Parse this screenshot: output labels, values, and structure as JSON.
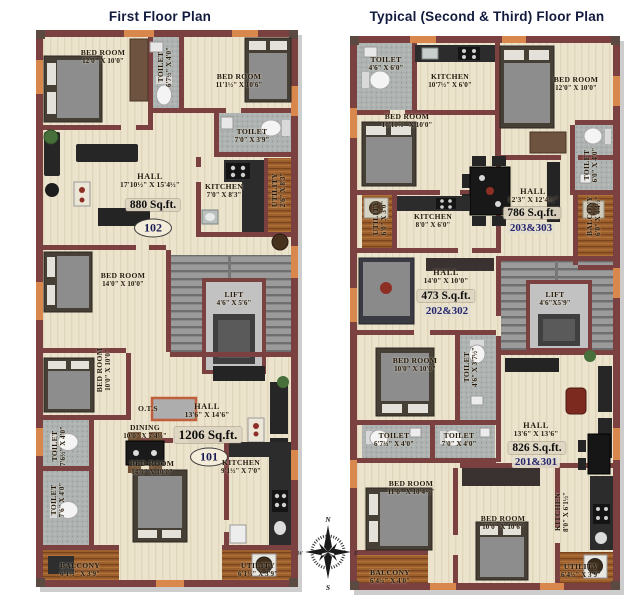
{
  "plans": {
    "left": {
      "title": "First Floor Plan",
      "rooms": {
        "bedroom_tl": {
          "name": "BED ROOM",
          "dims": "12'0\" X 10'0\""
        },
        "toilet_top": {
          "name": "TOILET",
          "dims": "6'7½\" X 4'0\""
        },
        "bedroom_tr": {
          "name": "BED ROOM",
          "dims": "11'1½\" X 10'6\""
        },
        "toilet_right": {
          "name": "TOILET",
          "dims": "7'0\" X 3'9\""
        },
        "hall_upper": {
          "name": "HALL",
          "dims": "17'10½\" X 15'4½\"",
          "area": "880 Sq.ft.",
          "unit": "102"
        },
        "kitchen_upper": {
          "name": "KITCHEN",
          "dims": "7'0\" X 8'3\""
        },
        "utility_side": {
          "name": "UTILITY",
          "dims": "2'6\" X 8'3\""
        },
        "bedroom_mid": {
          "name": "BED ROOM",
          "dims": "14'0\" X 10'0\""
        },
        "lift": {
          "name": "LIFT",
          "dims": "4'6\" X 5'6\""
        },
        "bedroom_small": {
          "name": "BED ROOM",
          "dims": "10'0\" X 10'0\""
        },
        "ots": {
          "name": "O.T.S"
        },
        "dining": {
          "name": "DINING",
          "dims": "10'0\" X 7'4½\""
        },
        "hall_lower": {
          "name": "HALL",
          "dims": "13'6\" X 14'6\"",
          "area": "1206 Sq.ft.",
          "unit": "101"
        },
        "toilet_mid_a": {
          "name": "TOILET",
          "dims": "7'6½\" X 4'0\""
        },
        "toilet_mid_b": {
          "name": "TOILET",
          "dims": "7'6\" X 4'0\""
        },
        "bedroom_bottom": {
          "name": "BED ROOM",
          "dims": "14'0\" X 10'0\""
        },
        "kitchen_lower": {
          "name": "KITCHEN",
          "dims": "9'1½\" X 7'0\""
        },
        "balcony": {
          "name": "BALCONY",
          "dims": "6'1½\" X 3'9\""
        },
        "utility_bottom": {
          "name": "UTILITY",
          "dims": "6'1½\" X 3'9\""
        }
      }
    },
    "right": {
      "title": "Typical (Second & Third) Floor Plan",
      "rooms": {
        "toilet_tl": {
          "name": "TOILET",
          "dims": "4'6\" X 6'0\""
        },
        "kitchen_top": {
          "name": "KITCHEN",
          "dims": "10'7½\" X 6'0\""
        },
        "bedroom_tr": {
          "name": "BED ROOM",
          "dims": "12'0\" X 10'0\""
        },
        "bedroom_left": {
          "name": "BED ROOM",
          "dims": "10'10½\" X 10'0\""
        },
        "toilet_right": {
          "name": "TOILET",
          "dims": "6'0\" X 4'0\""
        },
        "balcony_right": {
          "name": "BALCONY",
          "dims": "6'0\" X 4'4½\""
        },
        "hall_786": {
          "name": "HALL",
          "dims": "12'3\" X 12'4½\"",
          "area": "786 S.q.ft.",
          "unit": "203&303"
        },
        "utility_mid": {
          "name": "UTILITY",
          "dims": "6'0\" X 3'0\""
        },
        "kitchen_mid": {
          "name": "KITCHEN",
          "dims": "8'0\" X 6'0\""
        },
        "hall_473": {
          "name": "HALL",
          "dims": "14'0\" X 10'0\"",
          "area": "473 S.q.ft.",
          "unit": "202&302"
        },
        "lift": {
          "name": "LIFT",
          "dims": "4'6\"X5'9\""
        },
        "bedroom_mid": {
          "name": "BED ROOM",
          "dims": "10'0\" X 10'0\""
        },
        "toilet_mid": {
          "name": "TOILET",
          "dims": "4'6\" X 3'7½\""
        },
        "toilet_a": {
          "name": "TOILET",
          "dims": "6'7½\" X 4'0\""
        },
        "toilet_b": {
          "name": "TOILET",
          "dims": "7'0\" X 4'0\""
        },
        "hall_826": {
          "name": "HALL",
          "dims": "13'6\" X 13'6\"",
          "area": "826 S.q.ft.",
          "unit": "201&301"
        },
        "bedroom_bot_left": {
          "name": "BED ROOM",
          "dims": "11'0\" X 10'4½\""
        },
        "bedroom_bot_mid": {
          "name": "BED ROOM",
          "dims": "10'0\" X 10'6\""
        },
        "kitchen_bot": {
          "name": "KITCHEN",
          "dims": "8'0\" X 6'1½\""
        },
        "balcony_bot": {
          "name": "BALCONY",
          "dims": "6'4½\" X 4'0\""
        },
        "utility_bot": {
          "name": "UTILITY",
          "dims": "6'4½\" X 3'9\""
        }
      }
    }
  },
  "compass": {
    "north": "N",
    "south": "S",
    "east": "E",
    "west": "W"
  },
  "colors": {
    "wall": "#7b4040",
    "accent": "#d8874d",
    "floor": "#ece3cd",
    "title": "#121a3e"
  }
}
